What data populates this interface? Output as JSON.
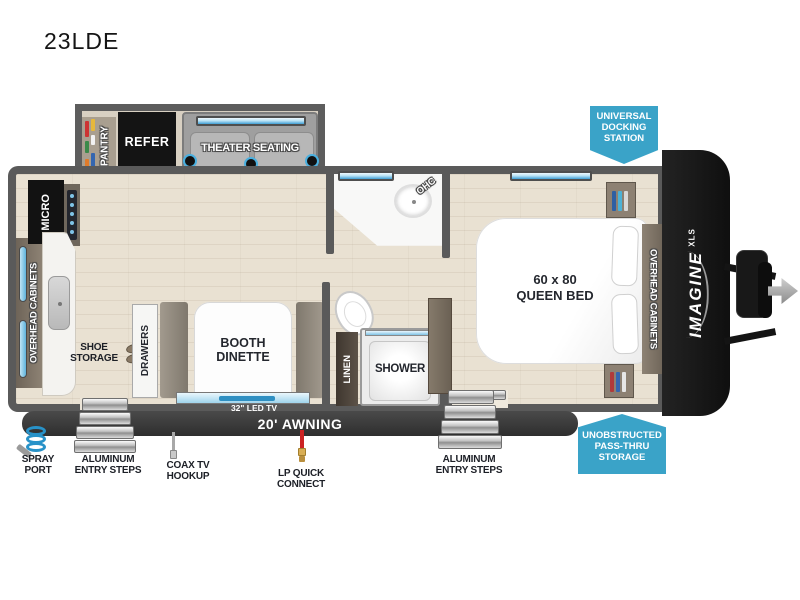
{
  "title": "23LDE",
  "plan": {
    "pantry": "PANTRY",
    "refer": "REFER",
    "theater_seating": "THEATER SEATING",
    "micro": "MICRO",
    "overhead_cabinets_left": "OVERHEAD CABINETS",
    "overhead_cabinets_right": "OVERHEAD CABINETS",
    "shoe_storage": [
      "SHOE",
      "STORAGE"
    ],
    "drawers": "DRAWERS",
    "booth_dinette": [
      "BOOTH",
      "DINETTE"
    ],
    "led_tv": "32\" LED TV",
    "ohc": "OHC",
    "linen": "LINEN",
    "shower": "SHOWER",
    "queen_bed": [
      "60 x 80",
      "QUEEN BED"
    ],
    "awning": "20' AWNING"
  },
  "logo": {
    "name": "IMAGINE",
    "sub": "XLS"
  },
  "badges": {
    "docking_station": [
      "UNIVERSAL",
      "DOCKING",
      "STATION"
    ],
    "pass_thru": [
      "UNOBSTRUCTED",
      "PASS-THRU",
      "STORAGE"
    ]
  },
  "exterior": {
    "spray_port": [
      "SPRAY",
      "PORT"
    ],
    "entry_steps_left": [
      "ALUMINUM",
      "ENTRY STEPS"
    ],
    "coax": [
      "COAX TV",
      "HOOKUP"
    ],
    "lp_connect": [
      "LP QUICK",
      "CONNECT"
    ],
    "entry_steps_right": [
      "ALUMINUM",
      "ENTRY STEPS"
    ]
  },
  "colors": {
    "badge_blue": "#3aa3c8",
    "wall_gray": "#5a5a5a",
    "window_blue": "#49a8d8",
    "floor_tan": "#e9e1d2"
  }
}
